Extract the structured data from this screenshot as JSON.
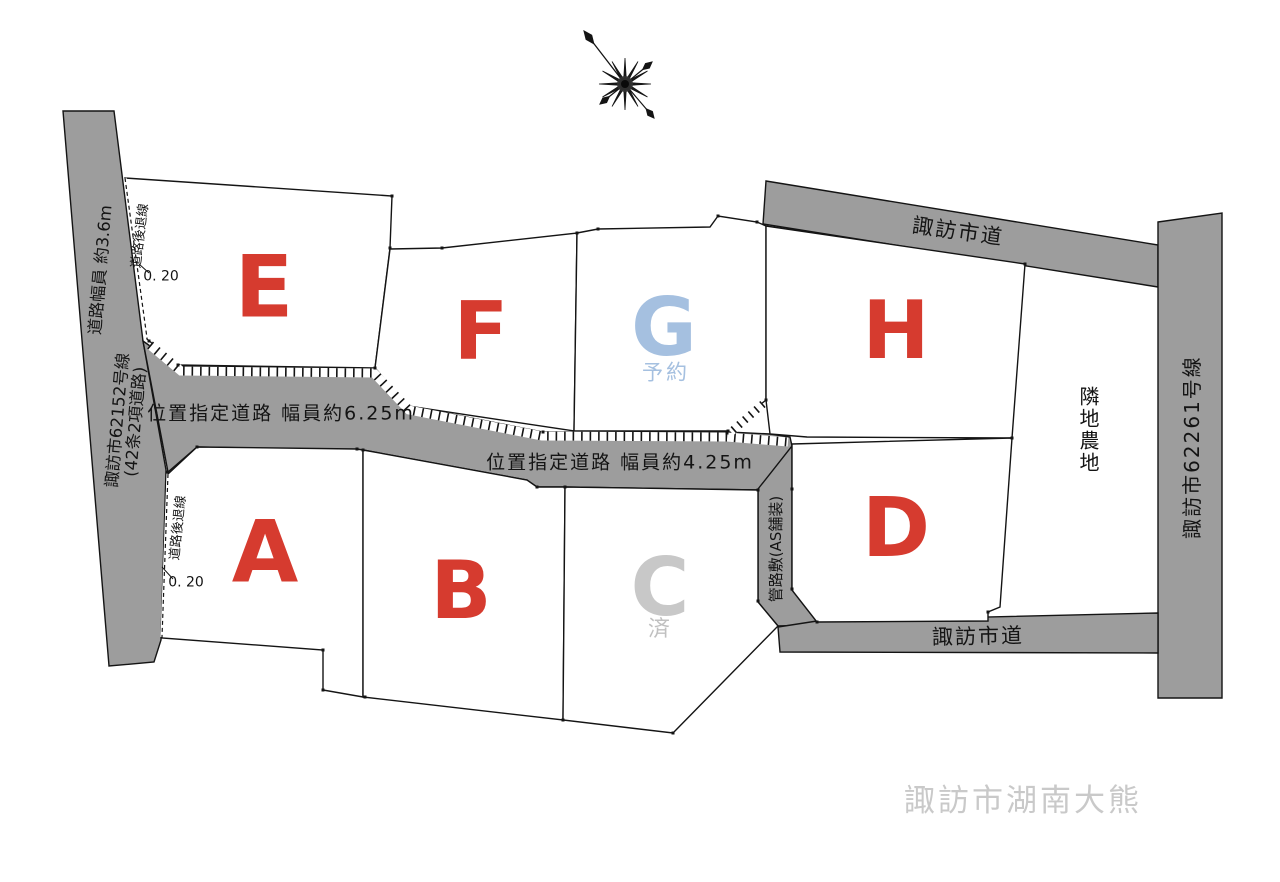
{
  "page": {
    "location_label": "諏訪市湖南大熊"
  },
  "colors": {
    "lot_letter_red": "#d63b2f",
    "reserved_blue": "#a5c0e0",
    "sold_gray": "#c8c8c8",
    "road_gray": "#9d9d9d",
    "location_text_gray": "#c9c9c9"
  },
  "lots": [
    {
      "id": "A",
      "label": "A",
      "status": ""
    },
    {
      "id": "B",
      "label": "B",
      "status": ""
    },
    {
      "id": "C",
      "label": "C",
      "status": "済"
    },
    {
      "id": "D",
      "label": "D",
      "status": ""
    },
    {
      "id": "E",
      "label": "E",
      "status": ""
    },
    {
      "id": "F",
      "label": "F",
      "status": ""
    },
    {
      "id": "G",
      "label": "G",
      "status": "予約"
    },
    {
      "id": "H",
      "label": "H",
      "status": ""
    }
  ],
  "roads": {
    "left_name": "諏訪市62152号線",
    "left_note": "(42条2項道路)",
    "left_width": "道路幅員 約3.6m",
    "designated_625": "位置指定道路 幅員約6.25m",
    "designated_425": "位置指定道路 幅員約4.25m",
    "city_road_top": "諏訪市道",
    "city_road_bottom": "諏訪市道",
    "right_name": "諏訪市62261号線",
    "pipe_strip": "管路敷(AS舗装)"
  },
  "annotations": {
    "setback_line_upper": "道路後退線",
    "setback_offset_upper": "0. 20",
    "setback_line_lower": "道路後退線",
    "setback_offset_lower": "0. 20",
    "adjacent_land": "隣地農地"
  }
}
